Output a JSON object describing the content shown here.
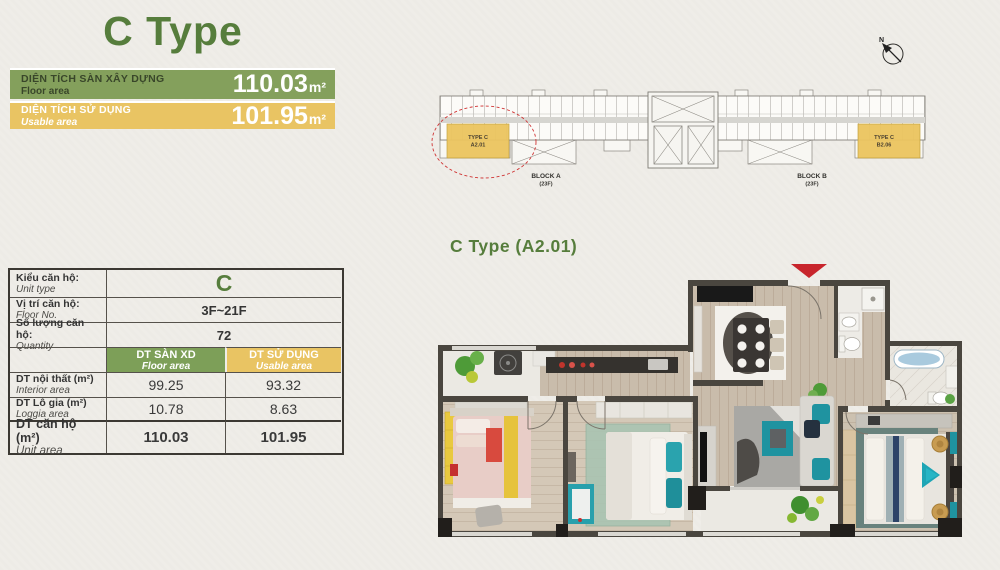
{
  "page": {
    "title": "C Type",
    "plan_label": "C Type (A2.01)"
  },
  "colors": {
    "accent-green": "#567d3c",
    "bar-green": "#84a05c",
    "bar-yellow": "#e9c463",
    "highlight-red": "#cf2b2b",
    "text-dark": "#343434",
    "paper": "#efede8",
    "wall": "#4a463f"
  },
  "area_bars": [
    {
      "label_vi": "DIỆN TÍCH SÀN XÂY DỰNG",
      "label_en": "Floor area",
      "value": "110.03",
      "unit": "m²"
    },
    {
      "label_vi": "DIỆN TÍCH SỬ DỤNG",
      "label_en": "Usable area",
      "value": "101.95",
      "unit": "m²"
    }
  ],
  "table": {
    "info_rows": [
      {
        "label_vi": "Kiểu căn hộ:",
        "label_en": "Unit type",
        "value": "C"
      },
      {
        "label_vi": "Vị trí căn hộ:",
        "label_en": "Floor No.",
        "value": "3F~21F"
      },
      {
        "label_vi": "Số lượng căn hộ:",
        "label_en": "Quantity",
        "value": "72"
      }
    ],
    "col_headers": [
      {
        "vi": "DT SÀN XD",
        "en": "Floor area"
      },
      {
        "vi": "DT SỬ DỤNG",
        "en": "Usable area"
      }
    ],
    "area_rows": [
      {
        "label_vi": "DT nội thất (m²)",
        "label_en": "Interior area",
        "floor": "99.25",
        "usable": "93.32"
      },
      {
        "label_vi": "DT Lô gia (m²)",
        "label_en": "Loggia area",
        "floor": "10.78",
        "usable": "8.63"
      },
      {
        "label_vi": "DT căn hộ (m²)",
        "label_en": "Unit area",
        "floor": "110.03",
        "usable": "101.95"
      }
    ]
  },
  "site_plan": {
    "north_label": "N",
    "unit_a_line1": "TYPE C",
    "unit_a_line2": "A2.01",
    "unit_b_line1": "TYPE C",
    "unit_b_line2": "B2.06",
    "block_a_line1": "BLOCK A",
    "block_a_line2": "(23F)",
    "block_b_line1": "BLOCK B",
    "block_b_line2": "(23F)"
  }
}
